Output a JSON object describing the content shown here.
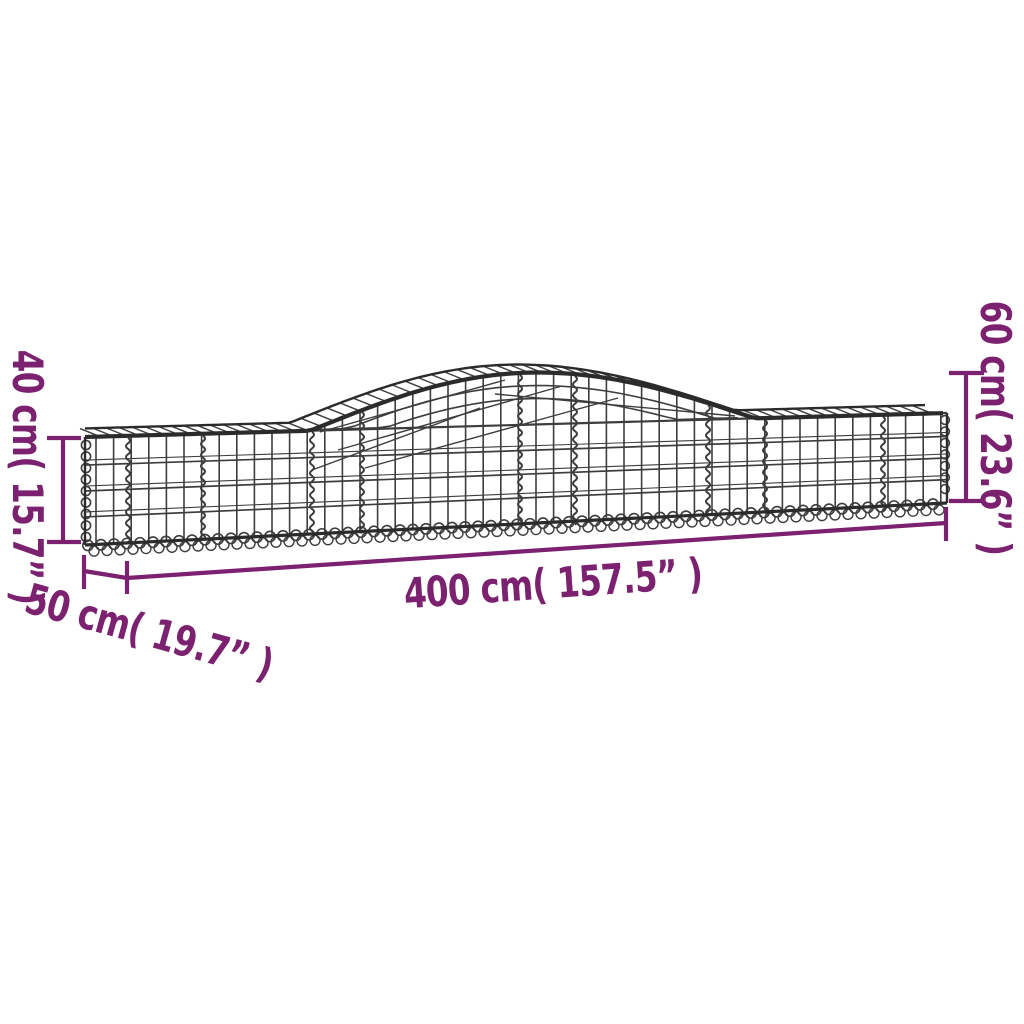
{
  "page": {
    "background_color": "#ffffff"
  },
  "illustration": {
    "mesh_color": "#3d3d3d",
    "rim_color": "#2b2b2b"
  },
  "dimensions": {
    "color": "#7b2170",
    "length": {
      "label": "400 cm( 157.5” )"
    },
    "depth": {
      "label": "50 cm( 19.7” )"
    },
    "height_left": {
      "label": "40 cm( 15.7” )"
    },
    "height_right": {
      "label": "60 cm( 23.6” )"
    }
  }
}
